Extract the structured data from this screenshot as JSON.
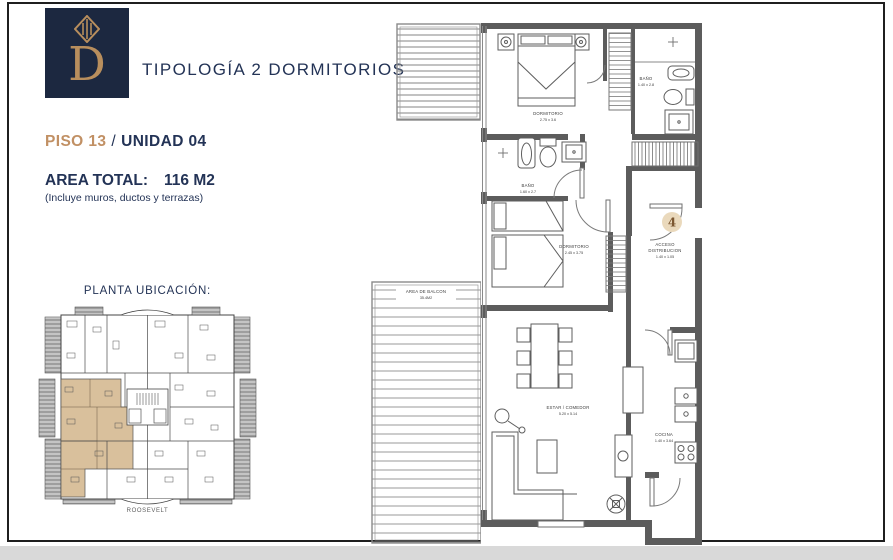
{
  "header": {
    "logo_letter": "D",
    "title": "TIPOLOGÍA 2 DORMITORIOS"
  },
  "unit": {
    "floor_label": "PISO 13",
    "separator": "/",
    "unit_label": "UNIDAD 04",
    "area_label": "AREA TOTAL:",
    "area_value": "116 M2",
    "area_note": "(Incluye muros, ductos y terrazas)",
    "unit_number": "4"
  },
  "location": {
    "title": "PLANTA UBICACIÓN:",
    "building_name": "ROOSEVELT"
  },
  "floorplan": {
    "rooms": {
      "dormitorio1": {
        "name": "DORMITORIO",
        "dims": "2.75 x 3.6"
      },
      "bano1": {
        "name": "BAÑO",
        "dims": "1.40 x 2.8"
      },
      "bano2": {
        "name": "BAÑO",
        "dims": "1.60 x 2.7"
      },
      "dormitorio2": {
        "name": "DORMITORIO",
        "dims": "2.45 x 3.75"
      },
      "acceso": {
        "name": "ACCESO",
        "name2": "DISTRIBUCION",
        "dims": "1.40 x 1.05"
      },
      "balcon": {
        "name": "AREA DE BALCON",
        "dims": "35.4M2"
      },
      "estar": {
        "name": "ESTAR / COMEDOR",
        "dims": "5.20 x 5.14"
      },
      "cocina": {
        "name": "COCINA",
        "dims": "1.40 x 3.64"
      }
    }
  },
  "colors": {
    "navy": "#1c2840",
    "gold": "#b88e5d",
    "piso_gold": "#c19064",
    "unit_highlight": "#d9c09c",
    "wall_gray": "#5c5c5c",
    "page_strip": "#d9d9d9"
  }
}
